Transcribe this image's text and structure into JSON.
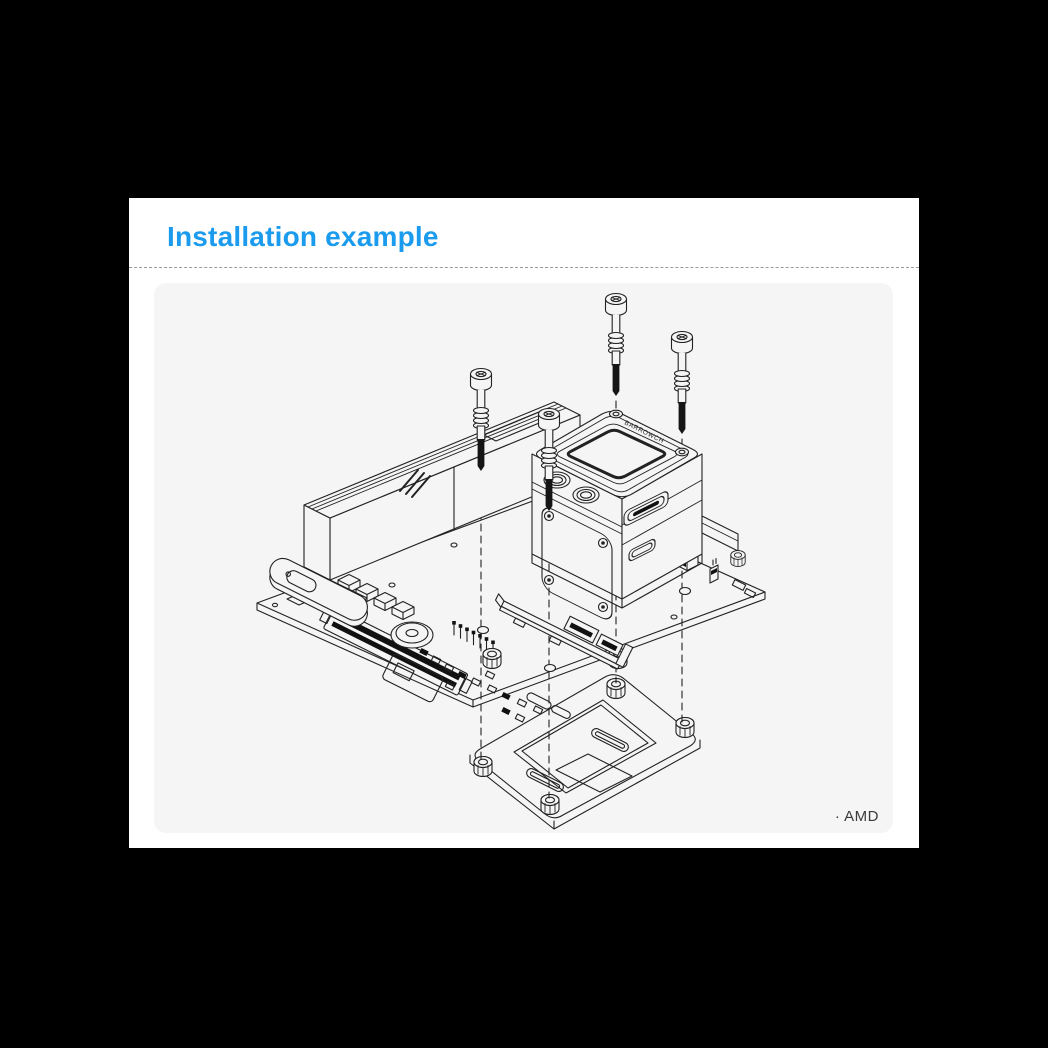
{
  "header": {
    "title": "Installation example"
  },
  "figure": {
    "footnote": "· AMD",
    "block_logo": "BARROWCH",
    "parts": [
      "mounting-screws",
      "cpu-water-block",
      "vrm-monoblock",
      "mini-itx-motherboard",
      "amd-backplate"
    ]
  },
  "colors": {
    "accent": "#1b9bee",
    "page_background": "#000000",
    "card_background": "#ffffff",
    "panel_background": "#f5f5f5",
    "line": "#222222",
    "divider": "#9a9a9a",
    "footnote_text": "#3a3a3a"
  }
}
